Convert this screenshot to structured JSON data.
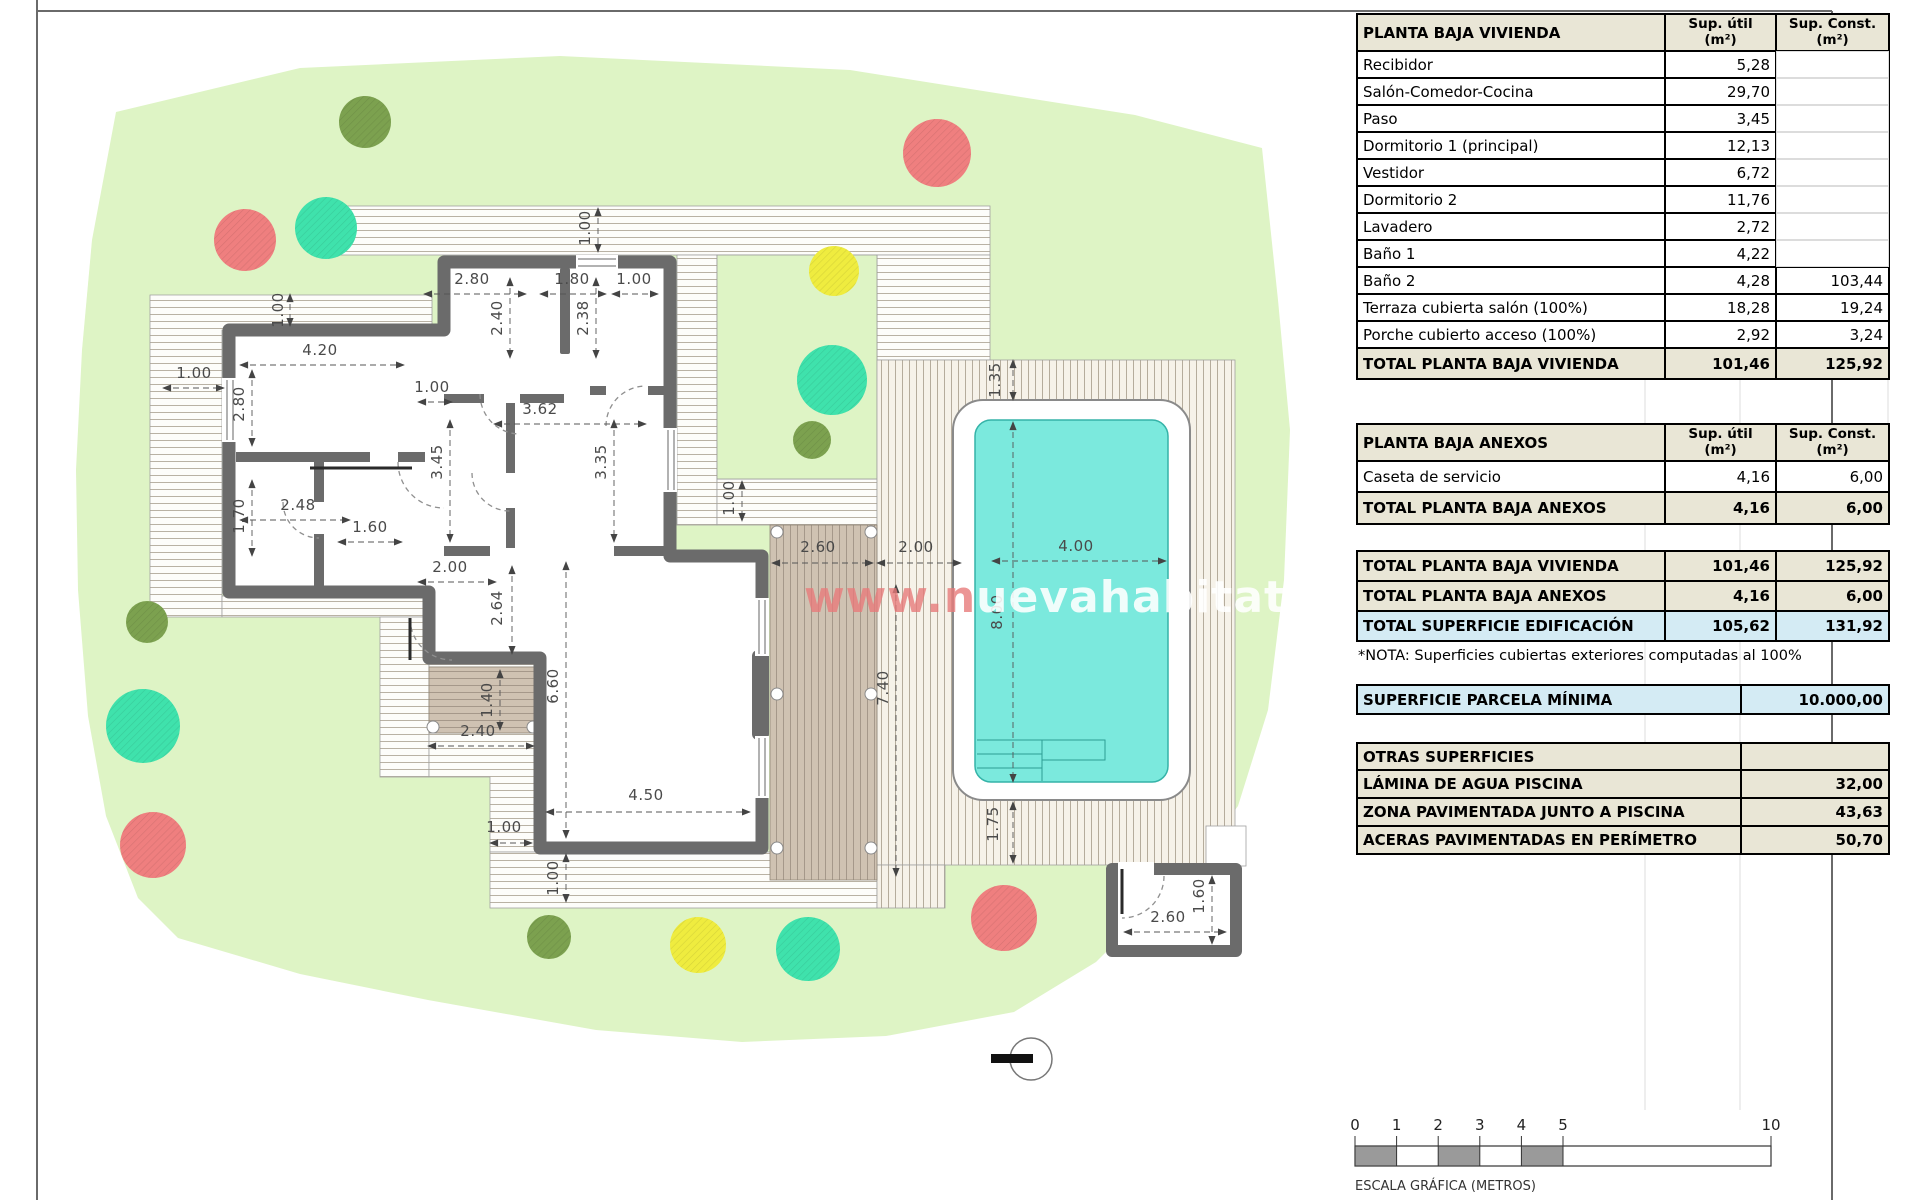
{
  "colors": {
    "garden": "#def4c5",
    "wall": "#6b6b6b",
    "pool_water": "#7be9dd",
    "pool_edge": "#35b3a8",
    "deck_brown": "#cfc2b2",
    "beige": "#e9e6d6",
    "blue": "#d4ebf4",
    "tree_red": "#ef7f7f",
    "tree_teal": "#3fe2ac",
    "tree_yellow": "#efec3f",
    "tree_olive": "#7ca14f"
  },
  "watermark": {
    "part1": "www.n",
    "part2": "uevahabitat.es"
  },
  "tables": {
    "vivienda": {
      "title": "PLANTA BAJA VIVIENDA",
      "col_util": "Sup. útil\n(m²)",
      "col_const": "Sup. Const.\n(m²)",
      "rows": [
        [
          "Recibidor",
          "5,28",
          ""
        ],
        [
          "Salón-Comedor-Cocina",
          "29,70",
          ""
        ],
        [
          "Paso",
          "3,45",
          ""
        ],
        [
          "Dormitorio 1 (principal)",
          "12,13",
          ""
        ],
        [
          "Vestidor",
          "6,72",
          ""
        ],
        [
          "Dormitorio 2",
          "11,76",
          ""
        ],
        [
          "Lavadero",
          "2,72",
          ""
        ],
        [
          "Baño 1",
          "4,22",
          ""
        ],
        [
          "Baño 2",
          "4,28",
          "103,44"
        ],
        [
          "Terraza cubierta salón (100%)",
          "18,28",
          "19,24"
        ],
        [
          "Porche cubierto acceso (100%)",
          "2,92",
          "3,24"
        ]
      ],
      "total": [
        "TOTAL PLANTA BAJA VIVIENDA",
        "101,46",
        "125,92"
      ]
    },
    "anexos": {
      "title": "PLANTA BAJA ANEXOS",
      "col_util": "Sup. útil\n(m²)",
      "col_const": "Sup. Const.\n(m²)",
      "rows": [
        [
          "Caseta de servicio",
          "4,16",
          "6,00"
        ]
      ],
      "total": [
        "TOTAL PLANTA BAJA ANEXOS",
        "4,16",
        "6,00"
      ]
    },
    "resumen": [
      [
        "TOTAL PLANTA BAJA VIVIENDA",
        "101,46",
        "125,92",
        "beige"
      ],
      [
        "TOTAL PLANTA BAJA ANEXOS",
        "4,16",
        "6,00",
        "beige"
      ],
      [
        "TOTAL SUPERFICIE EDIFICACIÓN",
        "105,62",
        "131,92",
        "blue"
      ]
    ],
    "nota": "*NOTA: Superficies cubiertas exteriores computadas al 100%",
    "parcela": {
      "label": "SUPERFICIE PARCELA MÍNIMA",
      "value": "10.000,00"
    },
    "otras": {
      "title": "OTRAS SUPERFICIES",
      "rows": [
        [
          "LÁMINA DE AGUA PISCINA",
          "32,00"
        ],
        [
          "ZONA PAVIMENTADA JUNTO A PISCINA",
          "43,63"
        ],
        [
          "ACERAS PAVIMENTADAS EN PERÍMETRO",
          "50,70"
        ]
      ]
    }
  },
  "plan": {
    "dimensions": [
      {
        "t": "1.00",
        "x": 590,
        "y": 228,
        "r": -90,
        "l": [
          598,
          208,
          598,
          252
        ]
      },
      {
        "t": "2.80",
        "x": 472,
        "y": 284,
        "r": 0,
        "l": [
          424,
          294,
          526,
          294
        ]
      },
      {
        "t": "1.80",
        "x": 572,
        "y": 284,
        "r": 0,
        "l": [
          540,
          294,
          606,
          294
        ]
      },
      {
        "t": "1.00",
        "x": 634,
        "y": 284,
        "r": 0,
        "l": [
          612,
          294,
          658,
          294
        ]
      },
      {
        "t": "2.40",
        "x": 502,
        "y": 318,
        "r": -90,
        "l": [
          510,
          278,
          510,
          358
        ]
      },
      {
        "t": "2.38",
        "x": 588,
        "y": 318,
        "r": -90,
        "l": [
          596,
          278,
          596,
          358
        ]
      },
      {
        "t": "4.20",
        "x": 320,
        "y": 355,
        "r": 0,
        "l": [
          240,
          365,
          404,
          365
        ]
      },
      {
        "t": "1.00",
        "x": 194,
        "y": 378,
        "r": 0,
        "l": [
          163,
          388,
          224,
          388
        ]
      },
      {
        "t": "1.00",
        "x": 283,
        "y": 310,
        "r": -90,
        "l": [
          290,
          294,
          290,
          326
        ]
      },
      {
        "t": "2.80",
        "x": 244,
        "y": 404,
        "r": -90,
        "l": [
          252,
          370,
          252,
          446
        ]
      },
      {
        "t": "1.00",
        "x": 432,
        "y": 392,
        "r": 0,
        "l": [
          418,
          402,
          452,
          402
        ]
      },
      {
        "t": "3.62",
        "x": 540,
        "y": 414,
        "r": 0,
        "l": [
          494,
          424,
          646,
          424
        ]
      },
      {
        "t": "3.45",
        "x": 442,
        "y": 462,
        "r": -90,
        "l": [
          450,
          420,
          450,
          542
        ]
      },
      {
        "t": "3.35",
        "x": 606,
        "y": 462,
        "r": -90,
        "l": [
          614,
          420,
          614,
          542
        ]
      },
      {
        "t": "1.70",
        "x": 244,
        "y": 516,
        "r": -90,
        "l": [
          252,
          480,
          252,
          556
        ]
      },
      {
        "t": "2.48",
        "x": 298,
        "y": 510,
        "r": 0,
        "l": [
          240,
          520,
          350,
          520
        ]
      },
      {
        "t": "1.60",
        "x": 370,
        "y": 532,
        "r": 0,
        "l": [
          338,
          542,
          402,
          542
        ]
      },
      {
        "t": "2.00",
        "x": 450,
        "y": 572,
        "r": 0,
        "l": [
          418,
          582,
          496,
          582
        ]
      },
      {
        "t": "2.64",
        "x": 502,
        "y": 608,
        "r": -90,
        "l": [
          512,
          566,
          512,
          654
        ]
      },
      {
        "t": "1.40",
        "x": 492,
        "y": 700,
        "r": -90,
        "l": [
          500,
          670,
          500,
          730
        ]
      },
      {
        "t": "2.40",
        "x": 478,
        "y": 736,
        "r": 0,
        "l": [
          428,
          746,
          534,
          746
        ]
      },
      {
        "t": "6.60",
        "x": 558,
        "y": 686,
        "r": -90,
        "l": [
          566,
          562,
          566,
          838
        ]
      },
      {
        "t": "4.50",
        "x": 646,
        "y": 800,
        "r": 0,
        "l": [
          546,
          812,
          750,
          812
        ]
      },
      {
        "t": "1.00",
        "x": 504,
        "y": 832,
        "r": 0,
        "l": [
          490,
          843,
          532,
          843
        ]
      },
      {
        "t": "1.00",
        "x": 558,
        "y": 878,
        "r": -90,
        "l": [
          566,
          854,
          566,
          902
        ]
      },
      {
        "t": "1.00",
        "x": 734,
        "y": 498,
        "r": -90,
        "l": [
          742,
          481,
          742,
          521
        ]
      },
      {
        "t": "2.60",
        "x": 818,
        "y": 552,
        "r": 0,
        "l": [
          772,
          563,
          873,
          563
        ]
      },
      {
        "t": "2.00",
        "x": 916,
        "y": 552,
        "r": 0,
        "l": [
          877,
          563,
          961,
          563
        ]
      },
      {
        "t": "4.00",
        "x": 1076,
        "y": 551,
        "r": 0,
        "l": [
          992,
          561,
          1166,
          561
        ]
      },
      {
        "t": "1.35",
        "x": 1000,
        "y": 380,
        "r": -90,
        "l": [
          1013,
          360,
          1013,
          400
        ]
      },
      {
        "t": "8.00",
        "x": 1002,
        "y": 612,
        "r": -90,
        "l": [
          1013,
          422,
          1013,
          782
        ]
      },
      {
        "t": "7.40",
        "x": 888,
        "y": 688,
        "r": -90,
        "l": [
          896,
          585,
          896,
          876
        ]
      },
      {
        "t": "1.75",
        "x": 998,
        "y": 824,
        "r": -90,
        "l": [
          1013,
          802,
          1013,
          863
        ]
      },
      {
        "t": "2.60",
        "x": 1168,
        "y": 922,
        "r": 0,
        "l": [
          1124,
          932,
          1226,
          932
        ]
      },
      {
        "t": "1.60",
        "x": 1204,
        "y": 896,
        "r": -90,
        "l": [
          1212,
          876,
          1212,
          944
        ]
      }
    ],
    "trees": [
      {
        "x": 365,
        "y": 122,
        "r": 26,
        "c": "tree_olive"
      },
      {
        "x": 937,
        "y": 153,
        "r": 34,
        "c": "tree_red"
      },
      {
        "x": 245,
        "y": 240,
        "r": 31,
        "c": "tree_red"
      },
      {
        "x": 326,
        "y": 228,
        "r": 31,
        "c": "tree_teal"
      },
      {
        "x": 834,
        "y": 271,
        "r": 25,
        "c": "tree_yellow"
      },
      {
        "x": 832,
        "y": 380,
        "r": 35,
        "c": "tree_teal"
      },
      {
        "x": 812,
        "y": 440,
        "r": 19,
        "c": "tree_olive"
      },
      {
        "x": 147,
        "y": 622,
        "r": 21,
        "c": "tree_olive"
      },
      {
        "x": 143,
        "y": 726,
        "r": 37,
        "c": "tree_teal"
      },
      {
        "x": 153,
        "y": 845,
        "r": 33,
        "c": "tree_red"
      },
      {
        "x": 549,
        "y": 937,
        "r": 22,
        "c": "tree_olive"
      },
      {
        "x": 698,
        "y": 945,
        "r": 28,
        "c": "tree_yellow"
      },
      {
        "x": 808,
        "y": 949,
        "r": 32,
        "c": "tree_teal"
      },
      {
        "x": 1004,
        "y": 918,
        "r": 33,
        "c": "tree_red"
      }
    ]
  },
  "scalebar": {
    "x0": 1355,
    "y": 1146,
    "h": 20,
    "unit": 41.6,
    "ticks": [
      "0",
      "1",
      "2",
      "3",
      "4",
      "5",
      "10"
    ],
    "tick_values": [
      0,
      1,
      2,
      3,
      4,
      5,
      10
    ],
    "filled": [
      [
        0,
        1
      ],
      [
        2,
        3
      ],
      [
        4,
        5
      ]
    ],
    "label": "ESCALA GRÁFICA (METROS)"
  }
}
